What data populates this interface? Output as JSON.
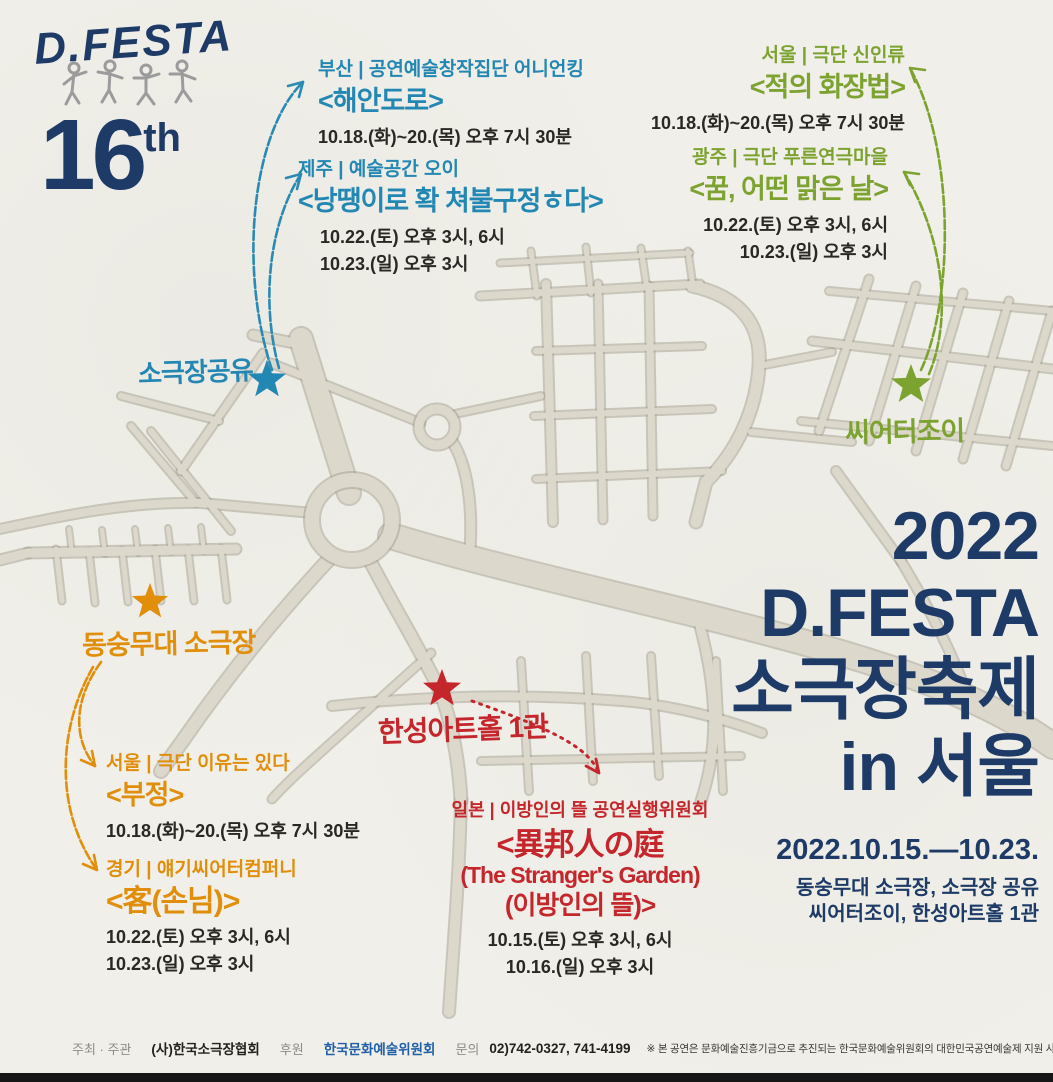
{
  "poster": {
    "logo": {
      "brand": "D.FESTA",
      "edition_number": "16",
      "edition_suffix": "th"
    },
    "colors": {
      "navy": "#1d3b66",
      "blue": "#2287b3",
      "green": "#7ca32f",
      "orange": "#e18f0a",
      "red": "#c5262c",
      "road": "#dcd8cc",
      "paper": "#f0efe9"
    },
    "venues": [
      {
        "label": "소극장공유",
        "marker_color": "#2287b3"
      },
      {
        "label": "씨어터조이",
        "marker_color": "#7ca32f"
      },
      {
        "label": "동숭무대 소극장",
        "marker_color": "#e18f0a"
      },
      {
        "label": "한성아트홀 1관",
        "marker_color": "#c5262c"
      }
    ],
    "shows": [
      {
        "group": "blue",
        "region_company": "부산 | 공연예술창작집단 어니언킹",
        "title": "<해안도로>",
        "schedule": [
          "10.18.(화)~20.(목) 오후 7시 30분"
        ]
      },
      {
        "group": "blue",
        "region_company": "제주 | 예술공간 오이",
        "title": "<낭땡이로 확 쳐불구정ㅎ다>",
        "schedule": [
          "10.22.(토) 오후 3시, 6시",
          "10.23.(일) 오후 3시"
        ]
      },
      {
        "group": "green",
        "region_company": "서울 | 극단 신인류",
        "title": "<적의 화장법>",
        "schedule": [
          "10.18.(화)~20.(목) 오후 7시 30분"
        ]
      },
      {
        "group": "green",
        "region_company": "광주 | 극단 푸른연극마을",
        "title": "<꿈, 어떤 맑은 날>",
        "schedule": [
          "10.22.(토) 오후 3시, 6시",
          "10.23.(일) 오후 3시"
        ]
      },
      {
        "group": "orange",
        "region_company": "서울 | 극단 이유는 있다",
        "title": "<부정>",
        "schedule": [
          "10.18.(화)~20.(목) 오후 7시 30분"
        ]
      },
      {
        "group": "orange",
        "region_company": "경기 | 얘기씨어터컴퍼니",
        "title": "<客(손님)>",
        "schedule": [
          "10.22.(토) 오후 3시, 6시",
          "10.23.(일) 오후 3시"
        ]
      },
      {
        "group": "red",
        "region_company": "일본 | 이방인의 뜰 공연실행위원회",
        "title_lines": [
          "<異邦人の庭",
          "(The Stranger's Garden)",
          "(이방인의 뜰)>"
        ],
        "schedule": [
          "10.15.(토) 오후 3시, 6시",
          "10.16.(일) 오후 3시"
        ]
      }
    ],
    "festival": {
      "year": "2022",
      "brand": "D.FESTA",
      "name": "소극장축제",
      "location": "in 서울",
      "dates": "2022.10.15.—10.23.",
      "venues_line1": "동숭무대 소극장, 소극장 공유",
      "venues_line2": "씨어터조이, 한성아트홀 1관"
    },
    "footer": {
      "host_label": "주최 · 주관",
      "host_org": "(사)한국소극장협회",
      "sponsor_label": "후원",
      "sponsor_org": "한국문화예술위원회",
      "contact_label": "문의",
      "contact_phone": "02)742-0327, 741-4199",
      "notice": "※ 본 공연은 문화예술진흥기금으로 추진되는 한국문화예술위원회의 대한민국공연예술제 지원 사업에 선정된 공연입니다."
    }
  }
}
